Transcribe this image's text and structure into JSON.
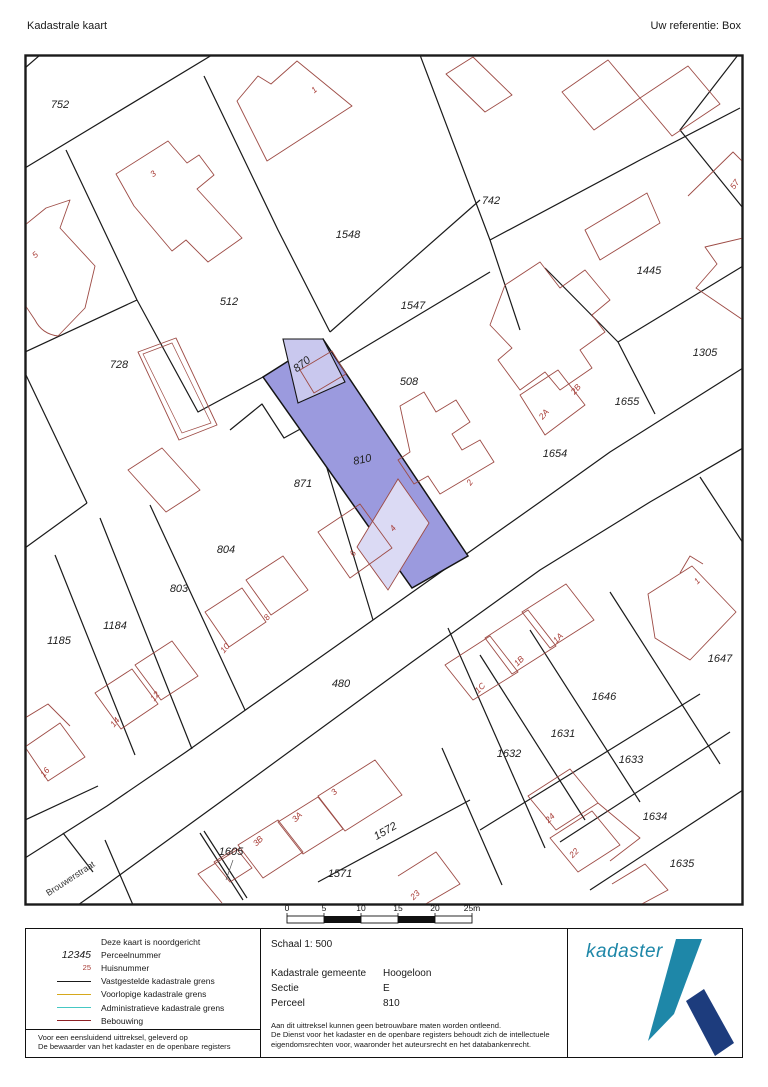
{
  "header": {
    "title": "Kadastrale kaart",
    "reference": "Uw referentie: Box"
  },
  "map": {
    "street": "Brouwerstraat",
    "parcels": {
      "p752": "752",
      "p1548": "1548",
      "p742": "742",
      "p1445": "1445",
      "p512": "512",
      "p1547": "1547",
      "p1305": "1305",
      "p728": "728",
      "p870": "870",
      "p508": "508",
      "p1655": "1655",
      "p1654": "1654",
      "p871": "871",
      "p810": "810",
      "p804": "804",
      "p803": "803",
      "p1184": "1184",
      "p1185": "1185",
      "p480": "480",
      "p1647": "1647",
      "p1646": "1646",
      "p1631": "1631",
      "p1632": "1632",
      "p1633": "1633",
      "p1634": "1634",
      "p1635": "1635",
      "p1572": "1572",
      "p1571": "1571",
      "p1605": "1605"
    },
    "houses": {
      "h1": "1",
      "h3": "3",
      "h5": "5",
      "h57": "57",
      "h2b": "2B",
      "h2a": "2A",
      "h2": "2",
      "h4": "4",
      "h6": "6",
      "h8": "8",
      "h10": "10",
      "h12": "12",
      "h14": "14",
      "h16": "16",
      "h1a": "1A",
      "h1b": "1B",
      "h1c": "1C",
      "h1r": "1",
      "h3b": "3B",
      "h3a": "3A",
      "h3x": "3",
      "h23": "23",
      "h24": "24",
      "h22": "22"
    }
  },
  "scalebar": {
    "ticks": [
      "0",
      "5",
      "10",
      "15",
      "20",
      "25m"
    ]
  },
  "legend": {
    "north_note": "Deze kaart is noordgericht",
    "parcel_sample": "12345",
    "parcel_label": "Perceelnummer",
    "house_sample": "25",
    "house_label": "Huisnummer",
    "line1": "Vastgestelde kadastrale grens",
    "line2": "Voorlopige kadastrale grens",
    "line3": "Administratieve kadastrale grens",
    "line4": "Bebouwing",
    "footer_line1": "Voor een eensluidend uittreksel, geleverd op",
    "footer_line2": "De bewaarder van het kadaster en de openbare registers"
  },
  "details": {
    "scale": "Schaal 1: 500",
    "rows": [
      {
        "label": "Kadastrale gemeente",
        "value": "Hoogeloon"
      },
      {
        "label": "Sectie",
        "value": "E"
      },
      {
        "label": "Perceel",
        "value": "810"
      }
    ],
    "disclaimer1": "Aan dit uittreksel kunnen geen betrouwbare maten worden ontleend.",
    "disclaimer2": "De Dienst voor het kadaster en de openbare registers behoudt zich de intellectuele",
    "disclaimer3": "eigendomsrechten voor, waaronder het auteursrecht en het databankenrecht."
  },
  "logo": {
    "text": "kadaster"
  },
  "colors": {
    "highlight": "#9b9ade",
    "highlight_light": "#c9c8ee",
    "building_overlay": "#dbdaf4",
    "boundary": "#1a1a1a",
    "building": "#9d4b45",
    "house_number": "#a83c36",
    "provisional": "#d6a81c",
    "administrative": "#45c8c4",
    "bebouwing": "#8d2025",
    "logo_teal": "#1e87a8",
    "logo_dark": "#1d3c7d"
  }
}
